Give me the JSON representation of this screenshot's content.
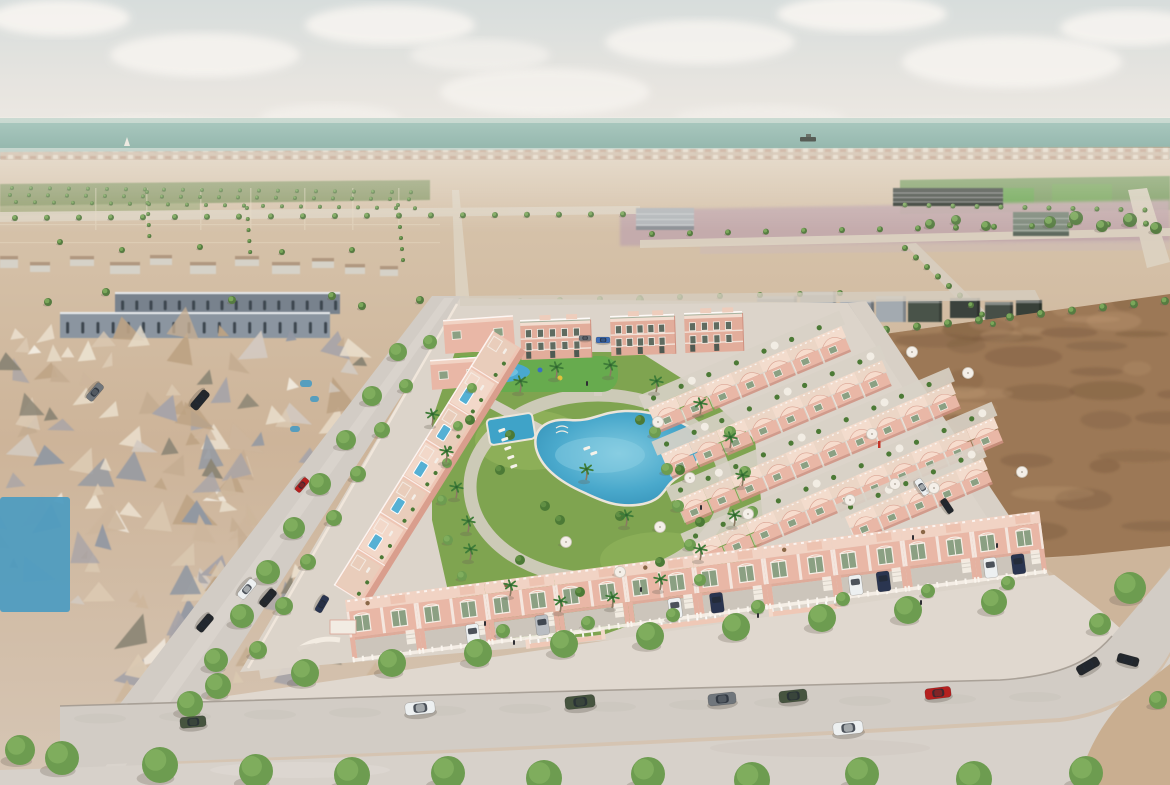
{
  "meta": {
    "description": "Aerial 3D architectural render: new-build pink residential development with communal pool and gardens, surrounded by existing town meshes, empty desert plots, tree-lined streets and the sea at the horizon",
    "width": 1170,
    "height": 785
  },
  "colors": {
    "sky_top": "#d7dddc",
    "sky_mid": "#e8e5e0",
    "sky_low": "#f1ede7",
    "cloud": "#f8f5f1",
    "sea": "#a6c5bc",
    "sea_deep": "#95b7ad",
    "town_base": "#c3ab92",
    "town_roof": "#ad7f62",
    "town_wall": "#e9dfcb",
    "sand_hi": "#d8c6ae",
    "sand": "#cdb499",
    "sand_low": "#d6c6b5",
    "field_left": "#8c9b6a",
    "field_right": "#7c9d62",
    "field_bright": "#6ca653",
    "lavender": "#c3aaac",
    "road": "#ddd3c2",
    "dirt": "#9c7856",
    "dirt_dark": "#7a5a3e",
    "dirt_light": "#bb9670",
    "plate": "#dcd4ca",
    "street": "#d2ccc5",
    "sidewalk": "#e0d8cf",
    "curb": "#9d958b",
    "foreground": "#d7d1ca",
    "desert_corner": "#c9ae90",
    "pink": "#e9b7a6",
    "pink_light": "#f7dccd",
    "pink_roof": "#f1d3c4",
    "pink_shadow": "#cf9181",
    "pink_deep": "#d99e8d",
    "white_trim": "#f6efe7",
    "window": "#8ba083",
    "window_dark": "#5f6b60",
    "park": "#7fa450",
    "park_light": "#96b75e",
    "hedge": "#4c7a36",
    "kids_pad": "#67ab4e",
    "pool": "#3fa3c8",
    "pool_light": "#7cc6e2",
    "pool_rim": "#ece5da",
    "tree": "#6d9c50",
    "tree_dark": "#567c41",
    "tree_inner": "#83b160",
    "palm": "#3e7c38",
    "trunk": "#8a7a62",
    "condo": "#78828d",
    "condo2": "#8b95a0",
    "condo_dark": "#3d4650",
    "shadow": "#6b6257",
    "car": {
      "white": "#edf0f1",
      "silver": "#b9bdc2",
      "grey": "#70767c",
      "black": "#23272c",
      "green": "#46543f",
      "red": "#b5201f",
      "navy": "#2a3550",
      "blue": "#3d6db5"
    }
  },
  "clouds": [
    [
      60,
      18,
      70,
      18,
      0.9
    ],
    [
      205,
      55,
      95,
      22,
      0.8
    ],
    [
      390,
      25,
      85,
      20,
      0.85
    ],
    [
      545,
      92,
      105,
      24,
      0.7
    ],
    [
      330,
      118,
      70,
      14,
      0.5
    ],
    [
      700,
      42,
      95,
      22,
      0.8
    ],
    [
      862,
      14,
      85,
      18,
      0.9
    ],
    [
      1012,
      62,
      110,
      26,
      0.8
    ],
    [
      1130,
      28,
      70,
      18,
      0.85
    ],
    [
      140,
      128,
      90,
      13,
      0.45
    ],
    [
      760,
      118,
      85,
      13,
      0.4
    ],
    [
      945,
      128,
      70,
      11,
      0.4
    ],
    [
      480,
      55,
      70,
      16,
      0.6
    ]
  ],
  "sea": {
    "ship": [
      800,
      137
    ],
    "sailboat": [
      127,
      137
    ]
  },
  "tree_rows": [
    [
      15,
      218,
      32,
      -0.2,
      20,
      3
    ],
    [
      652,
      234,
      38,
      -0.8,
      14,
      3
    ],
    [
      147,
      192,
      0.6,
      11,
      5,
      2
    ],
    [
      247,
      208,
      0.8,
      11,
      5,
      2
    ],
    [
      398,
      205,
      1,
      11,
      6,
      2
    ],
    [
      855,
      333,
      31,
      -3.2,
      11,
      4
    ],
    [
      905,
      248,
      11,
      9.5,
      9,
      3
    ],
    [
      868,
      350,
      17.5,
      23,
      10,
      5
    ],
    [
      692,
      323,
      27,
      1.5,
      6,
      4
    ],
    [
      12,
      188,
      19,
      0.2,
      22,
      2
    ],
    [
      10,
      195,
      19,
      0.2,
      22,
      2
    ],
    [
      16,
      202,
      19,
      0.3,
      22,
      2
    ],
    [
      905,
      205,
      24,
      0.5,
      11,
      2.5
    ],
    [
      520,
      301,
      40,
      -1,
      9,
      3
    ]
  ],
  "single_trees": [
    [
      60,
      242,
      3
    ],
    [
      122,
      250,
      3
    ],
    [
      200,
      247,
      3
    ],
    [
      282,
      252,
      3
    ],
    [
      352,
      250,
      3
    ],
    [
      48,
      302,
      4
    ],
    [
      106,
      292,
      4
    ],
    [
      232,
      300,
      4
    ],
    [
      332,
      296,
      4
    ],
    [
      362,
      306,
      4
    ],
    [
      420,
      300,
      4
    ],
    [
      1050,
      222,
      6
    ],
    [
      1076,
      218,
      7
    ],
    [
      1102,
      226,
      6
    ],
    [
      1130,
      220,
      7
    ],
    [
      1156,
      228,
      6
    ],
    [
      930,
      224,
      5
    ],
    [
      956,
      220,
      5
    ],
    [
      986,
      226,
      5
    ],
    [
      876,
      426,
      6
    ],
    [
      848,
      458,
      6
    ],
    [
      640,
      300,
      4
    ],
    [
      460,
      308,
      4
    ]
  ],
  "street_trees": [
    [
      218,
      686,
      13
    ],
    [
      305,
      673,
      14
    ],
    [
      392,
      663,
      14
    ],
    [
      478,
      653,
      14
    ],
    [
      564,
      644,
      14
    ],
    [
      650,
      636,
      14
    ],
    [
      736,
      627,
      14
    ],
    [
      822,
      618,
      14
    ],
    [
      908,
      610,
      14
    ],
    [
      994,
      602,
      13
    ],
    [
      1130,
      588,
      16
    ],
    [
      1100,
      624,
      11
    ],
    [
      1158,
      700,
      9
    ]
  ],
  "driveway_trees": [
    [
      503,
      631,
      7
    ],
    [
      588,
      623,
      7
    ],
    [
      673,
      615,
      7
    ],
    [
      758,
      607,
      7
    ],
    [
      843,
      599,
      7
    ],
    [
      928,
      591,
      7
    ],
    [
      1008,
      583,
      7
    ]
  ],
  "left_street_trees": [
    [
      398,
      352,
      9
    ],
    [
      372,
      396,
      10
    ],
    [
      346,
      440,
      10
    ],
    [
      320,
      484,
      11
    ],
    [
      294,
      528,
      11
    ],
    [
      268,
      572,
      12
    ],
    [
      242,
      616,
      12
    ],
    [
      216,
      660,
      12
    ],
    [
      190,
      704,
      13
    ],
    [
      430,
      342,
      7
    ],
    [
      406,
      386,
      7
    ],
    [
      382,
      430,
      8
    ],
    [
      358,
      474,
      8
    ],
    [
      334,
      518,
      8
    ],
    [
      308,
      562,
      8
    ],
    [
      284,
      606,
      9
    ],
    [
      258,
      650,
      9
    ]
  ],
  "foreground_trees": [
    [
      20,
      750,
      15
    ],
    [
      62,
      758,
      17
    ],
    [
      160,
      765,
      18
    ],
    [
      256,
      771,
      17
    ],
    [
      352,
      775,
      18
    ],
    [
      448,
      773,
      17
    ],
    [
      544,
      778,
      18
    ],
    [
      648,
      774,
      17
    ],
    [
      752,
      780,
      18
    ],
    [
      862,
      774,
      17
    ],
    [
      974,
      779,
      18
    ],
    [
      1086,
      773,
      17
    ]
  ],
  "internal_trees": [
    [
      655,
      432,
      6
    ],
    [
      667,
      469,
      6
    ],
    [
      678,
      506,
      6
    ],
    [
      690,
      545,
      6
    ],
    [
      700,
      580,
      6
    ],
    [
      472,
      388,
      5
    ],
    [
      458,
      426,
      5
    ],
    [
      447,
      463,
      5
    ],
    [
      442,
      500,
      5
    ],
    [
      448,
      540,
      5
    ],
    [
      462,
      576,
      5
    ],
    [
      730,
      432,
      6
    ],
    [
      745,
      472,
      6
    ],
    [
      752,
      512,
      6
    ]
  ],
  "park_bushes": [
    [
      470,
      420
    ],
    [
      500,
      470
    ],
    [
      545,
      506
    ],
    [
      620,
      516
    ],
    [
      680,
      470
    ],
    [
      640,
      420
    ],
    [
      700,
      522
    ],
    [
      520,
      560
    ],
    [
      580,
      592
    ],
    [
      660,
      562
    ],
    [
      510,
      435
    ],
    [
      560,
      520
    ]
  ],
  "palms": [
    [
      432,
      425
    ],
    [
      446,
      462
    ],
    [
      456,
      498
    ],
    [
      468,
      532
    ],
    [
      520,
      392
    ],
    [
      556,
      378
    ],
    [
      610,
      376
    ],
    [
      656,
      392
    ],
    [
      700,
      414
    ],
    [
      730,
      448
    ],
    [
      742,
      486
    ],
    [
      734,
      526
    ],
    [
      700,
      560
    ],
    [
      660,
      590
    ],
    [
      612,
      608
    ],
    [
      560,
      612
    ],
    [
      510,
      596
    ],
    [
      470,
      560
    ],
    [
      586,
      480
    ],
    [
      626,
      526
    ]
  ],
  "mesh_regions": [
    [
      0,
      322,
      360,
      146,
      70
    ],
    [
      0,
      460,
      300,
      158,
      55
    ],
    [
      118,
      556,
      280,
      140,
      45
    ],
    [
      1096,
      706,
      74,
      79,
      16
    ]
  ],
  "mesh_palette": [
    "#dbc9b2",
    "#cdb69c",
    "#bca283",
    "#eadfcd",
    "#d2c9c0",
    "#a7a4a8",
    "#9298a2",
    "#f1eadf",
    "#8a8474",
    "#c5ad92"
  ],
  "mesh_pools": [
    [
      0,
      497,
      70,
      115
    ],
    [
      300,
      380,
      12,
      7
    ],
    [
      310,
      396,
      9,
      6
    ],
    [
      290,
      426,
      10,
      6
    ]
  ],
  "scatter_buildings": [
    [
      70,
      256,
      24,
      10
    ],
    [
      110,
      262,
      30,
      12
    ],
    [
      150,
      255,
      22,
      10
    ],
    [
      190,
      262,
      26,
      12
    ],
    [
      235,
      256,
      24,
      10
    ],
    [
      272,
      262,
      28,
      12
    ],
    [
      312,
      258,
      22,
      10
    ],
    [
      345,
      264,
      20,
      10
    ],
    [
      30,
      262,
      20,
      10
    ],
    [
      0,
      256,
      18,
      12
    ],
    [
      380,
      266,
      18,
      10
    ]
  ],
  "condo_rows": [
    [
      115,
      292,
      225,
      22,
      16,
      "#78828d"
    ],
    [
      60,
      312,
      270,
      26,
      18,
      "#8b95a0"
    ]
  ],
  "greys": [
    [
      757,
      296,
      40,
      26,
      "#9aa1a8"
    ],
    [
      800,
      292,
      36,
      30,
      "#aab1b6"
    ],
    [
      840,
      300,
      34,
      24,
      "#8a9198"
    ],
    [
      876,
      296,
      30,
      26,
      "#a3aab0"
    ],
    [
      762,
      326,
      52,
      12,
      "#b7bcc0"
    ],
    [
      822,
      326,
      46,
      12,
      "#9fa6ac"
    ],
    [
      908,
      300,
      34,
      22,
      "#4a524a"
    ],
    [
      950,
      298,
      30,
      20,
      "#3a423c"
    ],
    [
      985,
      302,
      28,
      18,
      "#474f47"
    ],
    [
      1016,
      300,
      26,
      18,
      "#394039"
    ]
  ],
  "sheds": [
    [
      636,
      208,
      58,
      22,
      "#b3b7ba",
      "#8e9296"
    ],
    [
      1013,
      212,
      56,
      24,
      "#7e8a7c",
      "#5f6b5f"
    ],
    [
      893,
      188,
      110,
      18,
      "#3f463f",
      "#2b312b"
    ]
  ],
  "apartments": [
    [
      520,
      320,
      70,
      40,
      5
    ],
    [
      610,
      316,
      64,
      40,
      5
    ],
    [
      684,
      313,
      58,
      40,
      4
    ]
  ],
  "nw_blocks": [
    [
      443,
      320,
      70,
      34
    ],
    [
      430,
      360,
      56,
      30
    ]
  ],
  "row_specs": [
    [
      648,
      408,
      7
    ],
    [
      661,
      454,
      8
    ],
    [
      675,
      500,
      10
    ],
    [
      690,
      546,
      11
    ],
    [
      845,
      517,
      5
    ]
  ],
  "left_row": {
    "x": 332,
    "y": 584,
    "units": 7
  },
  "pergolas": [
    [
      525,
      638,
      80
    ],
    [
      648,
      620,
      80
    ],
    [
      768,
      606,
      72
    ]
  ],
  "front_row": {
    "x": 345,
    "y": 600,
    "units": 10,
    "uw": 70,
    "angle": -7.3
  },
  "front_units": [
    {},
    {
      "car": "white",
      "cx": 46
    },
    {
      "car": "silver",
      "cx": 46
    },
    {},
    {
      "car": "white",
      "cx": 40
    },
    {
      "car": "navy",
      "cx": 12
    },
    {},
    {
      "car": "white",
      "cx": 12,
      "car2": "navy",
      "cx2": 40
    },
    {},
    {
      "car": "white",
      "cx": 8,
      "car2": "navy",
      "cx2": 36
    }
  ],
  "umbrellas": [
    [
      566,
      542
    ],
    [
      660,
      527
    ],
    [
      748,
      514
    ],
    [
      850,
      500
    ],
    [
      934,
      488
    ],
    [
      1022,
      472
    ],
    [
      658,
      422
    ],
    [
      690,
      478
    ],
    [
      872,
      434
    ],
    [
      895,
      484
    ],
    [
      620,
      572
    ],
    [
      912,
      352
    ],
    [
      968,
      373
    ]
  ],
  "loungers": [
    [
      498,
      430
    ],
    [
      501,
      439
    ],
    [
      504,
      448
    ],
    [
      507,
      457
    ],
    [
      510,
      466
    ],
    [
      583,
      448
    ],
    [
      590,
      453
    ]
  ],
  "people": [
    [
      484,
      621
    ],
    [
      513,
      640
    ],
    [
      757,
      613
    ],
    [
      700,
      505
    ],
    [
      912,
      535
    ],
    [
      996,
      543
    ],
    [
      640,
      587
    ],
    [
      586,
      381
    ],
    [
      920,
      600
    ]
  ],
  "flag": [
    878,
    441
  ],
  "cars": [
    [
      193,
      722,
      26,
      "green",
      -5
    ],
    [
      420,
      708,
      30,
      "white",
      -6
    ],
    [
      580,
      702,
      30,
      "green",
      -6
    ],
    [
      722,
      699,
      28,
      "grey",
      -6
    ],
    [
      793,
      696,
      28,
      "green",
      -6
    ],
    [
      938,
      693,
      26,
      "red",
      -7
    ],
    [
      1088,
      666,
      24,
      "black",
      -30
    ],
    [
      848,
      728,
      30,
      "white",
      -6
    ],
    [
      922,
      487,
      18,
      "white",
      56
    ],
    [
      947,
      506,
      16,
      "black",
      56
    ],
    [
      1128,
      660,
      22,
      "black",
      15
    ],
    [
      95,
      392,
      20,
      "grey",
      130
    ],
    [
      200,
      400,
      22,
      "black",
      130
    ],
    [
      302,
      485,
      16,
      "red",
      130
    ],
    [
      247,
      589,
      22,
      "white",
      130
    ],
    [
      268,
      598,
      20,
      "black",
      130
    ],
    [
      205,
      623,
      20,
      "black",
      130
    ],
    [
      322,
      604,
      18,
      "navy",
      120
    ],
    [
      603,
      340,
      14,
      "blue",
      0
    ],
    [
      585,
      338,
      12,
      "grey",
      0
    ]
  ]
}
